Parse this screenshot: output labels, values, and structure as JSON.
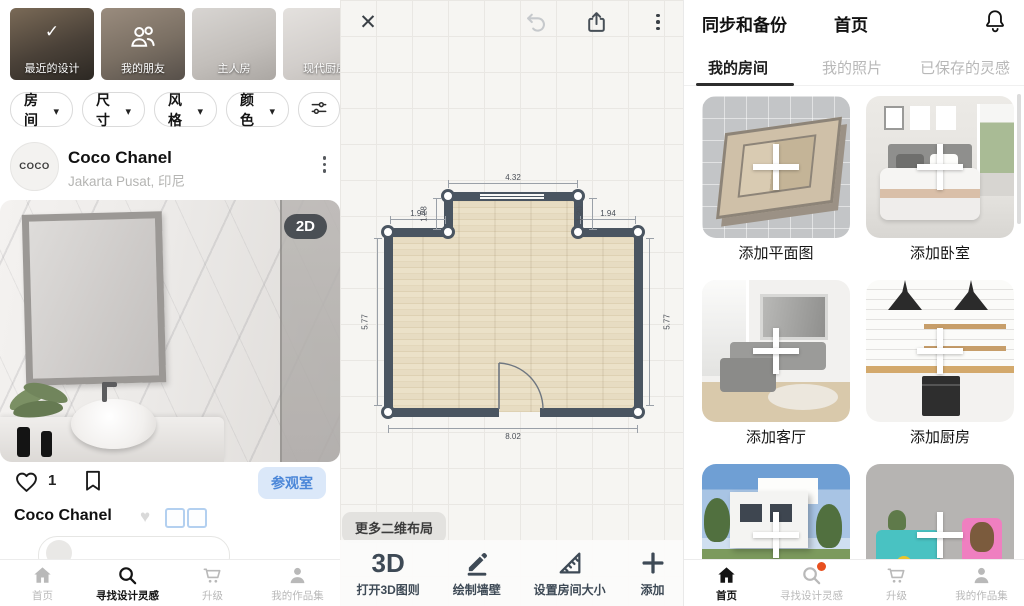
{
  "left_panel": {
    "stories": [
      {
        "label": "最近的设计"
      },
      {
        "label": "我的朋友"
      },
      {
        "label": "主人房"
      },
      {
        "label": "现代厨房"
      }
    ],
    "filter_chips": [
      {
        "label": "房间"
      },
      {
        "label": "尺寸"
      },
      {
        "label": "风格"
      },
      {
        "label": "颜色"
      }
    ],
    "profile": {
      "avatar_text": "COCO",
      "name": "Coco Chanel",
      "location": "Jakarta Pusat, 印尼"
    },
    "post": {
      "view_badge": "2D",
      "like_count": "1",
      "visit_room_button": "参观室",
      "caption_author": "Coco Chanel"
    },
    "bottom_nav": [
      {
        "label": "首页"
      },
      {
        "label": "寻找设计灵感"
      },
      {
        "label": "升级"
      },
      {
        "label": "我的作品集"
      }
    ]
  },
  "editor_panel": {
    "more_layouts_button": "更多二维布局",
    "floor_plan_dimensions": {
      "top_width": "4.32",
      "left_step": "1.94",
      "right_step": "1.94",
      "left_rise": "1.28",
      "right_rise": "1.20",
      "left_height": "5.77",
      "right_height": "5.77",
      "bottom_width": "8.02"
    },
    "toolbar": [
      {
        "icon_text": "3D",
        "label": "打开3D图则"
      },
      {
        "label": "绘制墙壁"
      },
      {
        "label": "设置房间大小"
      },
      {
        "label": "添加"
      }
    ]
  },
  "home_panel": {
    "header": {
      "left_action": "同步和备份",
      "title": "首页"
    },
    "tabs": [
      {
        "label": "我的房间"
      },
      {
        "label": "我的照片"
      },
      {
        "label": "已保存的灵感"
      }
    ],
    "cards": [
      {
        "label": "添加平面图"
      },
      {
        "label": "添加卧室"
      },
      {
        "label": "添加客厅"
      },
      {
        "label": "添加厨房"
      }
    ],
    "bottom_nav": [
      {
        "label": "首页"
      },
      {
        "label": "寻找设计灵感"
      },
      {
        "label": "升级"
      },
      {
        "label": "我的作品集"
      }
    ]
  },
  "colors": {
    "accent_blue": "#4a86d8",
    "visit_button_bg": "#dbe8f9",
    "badge_dark": "#363c42",
    "wall": "#4a5561",
    "floor": "#e8ddc2",
    "notification_dot": "#e8501f"
  }
}
